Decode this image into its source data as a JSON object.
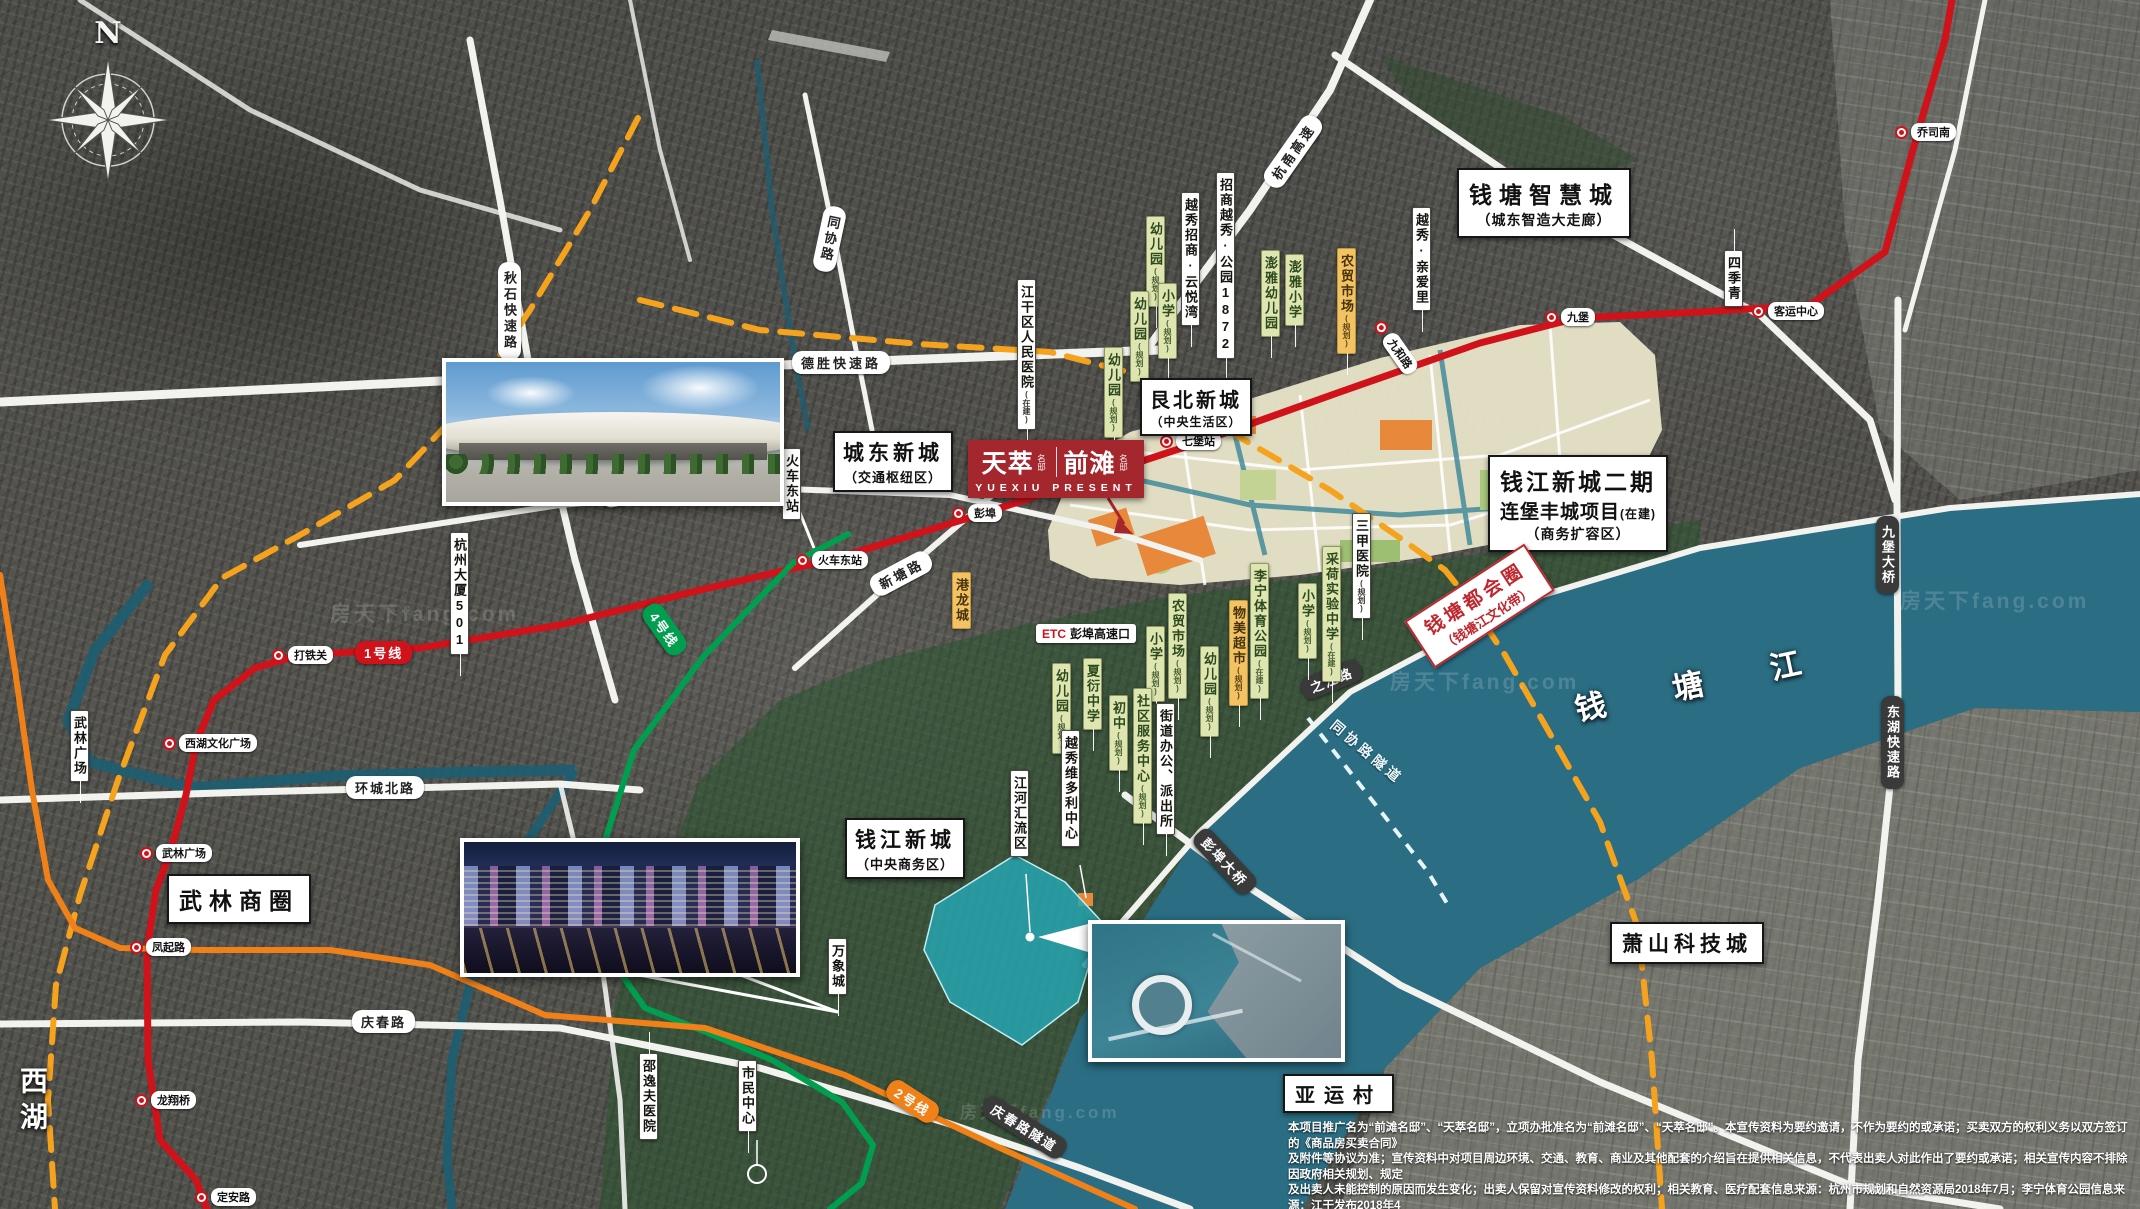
{
  "watermark": "房天下fang.com",
  "compass": {
    "north": "N"
  },
  "logo": {
    "brand1": "天萃",
    "brand1_suffix": "名邸",
    "brand2": "前滩",
    "brand2_suffix": "名邸",
    "subtitle": "YUEXIU PRESENT"
  },
  "districts": {
    "qiantang_smart": {
      "title": "钱塘智慧城",
      "subtitle": "（城东智造大走廊）"
    },
    "genbei": {
      "title": "艮北新城",
      "subtitle": "（中央生活区）"
    },
    "chengdong": {
      "title": "城东新城",
      "subtitle": "（交通枢纽区）"
    },
    "qianjiang2": {
      "title": "钱江新城二期",
      "line2": "连堡丰城项目",
      "line2_note": "(在建)",
      "subtitle": "（商务扩容区）"
    },
    "qianjiang": {
      "title": "钱江新城",
      "subtitle": "（中央商务区）"
    },
    "wulin": "武林商圈",
    "xiaoshan": "萧山科技城",
    "yayuncun": "亚运村",
    "xihu": "西湖",
    "qiantangjiang": "钱 塘 江",
    "metro_circle": {
      "title": "钱塘都会圈",
      "subtitle": "（钱塘江文化带）"
    }
  },
  "roads": {
    "desheng": "德胜快速路",
    "huancheng_north": "环城北路",
    "qingchun": "庆春路",
    "xintang": "新塘路",
    "genshan_east": "艮山东路",
    "qiushi": "秋石快速路",
    "tongxie": "同协路",
    "hangyong": "杭甬高速",
    "zhijiang": "之江路",
    "pengbu_bridge": "彭埠大桥",
    "qingchun_tunnel": "庆春路隧道",
    "jiubao_bridge": "九堡大桥",
    "donghu_express": "东湖快速路",
    "tongxie_tunnel": "同协路隧道"
  },
  "stations": [
    "打铁关",
    "西湖文化广场",
    "武林广场",
    "凤起路",
    "龙翔桥",
    "定安路",
    "彭埠",
    "火车东站",
    "七堡站",
    "九堡",
    "客运中心",
    "乔司南",
    "九和路"
  ],
  "metro_badges": {
    "line1": "1号线",
    "line2": "2号线",
    "line4": "4号线"
  },
  "etc": {
    "tag": "ETC",
    "name": "彭埠高速口"
  },
  "poi": [
    {
      "text": "幼儿园",
      "note": "(规划)"
    },
    {
      "text": "小学",
      "note": "(规划)"
    },
    {
      "text": "幼儿园",
      "note": "(规划)"
    },
    {
      "text": "幼儿园",
      "note": "(规划)"
    },
    {
      "text": "澎雅幼儿园",
      "note": ""
    },
    {
      "text": "澎雅小学",
      "note": ""
    },
    {
      "text": "农贸市场",
      "note": "(规划)"
    },
    {
      "text": "招商越秀·公园1872",
      "note": ""
    },
    {
      "text": "越秀招商·云悦湾",
      "note": ""
    },
    {
      "text": "越秀·亲爱里",
      "note": ""
    },
    {
      "text": "四季青",
      "note": ""
    },
    {
      "text": "江干区人民医院",
      "note": "(在建)"
    },
    {
      "text": "火车东站",
      "note": ""
    },
    {
      "text": "杭州大厦501",
      "note": ""
    },
    {
      "text": "港龙城",
      "note": ""
    },
    {
      "text": "三甲医院",
      "note": "(规划)"
    },
    {
      "text": "小学",
      "note": "(规划)"
    },
    {
      "text": "农贸市场",
      "note": "(规划)"
    },
    {
      "text": "幼儿园",
      "note": "(规划)"
    },
    {
      "text": "物美超市",
      "note": "(规划)"
    },
    {
      "text": "李宁体育公园",
      "note": "(在建)"
    },
    {
      "text": "小学",
      "note": "(规划)"
    },
    {
      "text": "采荷实验中学",
      "note": "(在建)"
    },
    {
      "text": "幼儿园",
      "note": "(规划)"
    },
    {
      "text": "夏衍中学",
      "note": ""
    },
    {
      "text": "初中",
      "note": "(规划)"
    },
    {
      "text": "社区服务中心",
      "note": "(规划)"
    },
    {
      "text": "街道办公、派出所",
      "note": ""
    },
    {
      "text": "越秀维多利中心",
      "note": ""
    },
    {
      "text": "江河汇流区",
      "note": ""
    },
    {
      "text": "万象城",
      "note": ""
    },
    {
      "text": "市民中心",
      "note": ""
    },
    {
      "text": "邵逸夫医院",
      "note": ""
    },
    {
      "text": "武林广场",
      "note": ""
    }
  ],
  "disclaimer": {
    "line1": "本项目推广名为“前滩名邸”、“天萃名邸”，立项办批准名为“前滩名邸”、“天萃名邸”。本宣传资料为要约邀请，不作为要约的或承诺；买卖双方的权利义务以双方签订的《商品房买卖合同》",
    "line2": "及附件等协议为准；宣传资料中对项目周边环境、交通、教育、商业及其他配套的介绍旨在提供相关信息，不代表出卖人对此作出了要约或承诺；相关宣传内容不排除因政府相关规划、规定",
    "line3": "及出卖人未能控制的原因而发生变化；出卖人保留对宣传资料修改的权利；相关教育、医疗配套信息来源：杭州市规划和自然资源局2018年7月；李宁体育公园信息来源：江干发布2018年4",
    "line4": "月26日；连堡丰城项目信息来源：浙青网2019年9月25日。本资料截止2019年9月27日项目周边情况的大致展示，有效期4个月，敬请留意最新资料。"
  }
}
